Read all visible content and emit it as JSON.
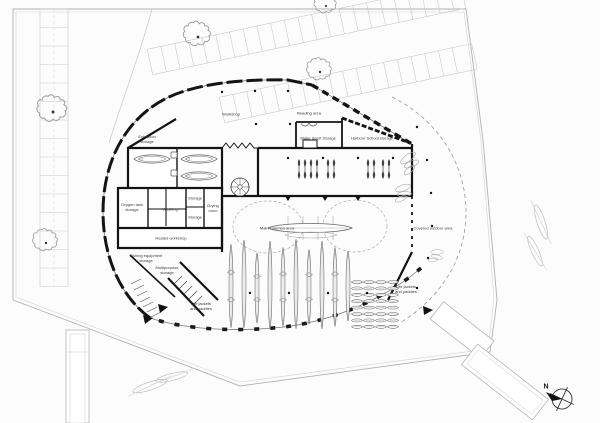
{
  "drawing": {
    "kind": "architectural ground-floor site plan",
    "building_shape": "organic egg-shaped boathouse with covered outdoor area",
    "colors": {
      "walls": "#141414",
      "site_lines": "#b0b0b0",
      "detail_lines": "#666666",
      "vegetation": "#9a9a9a",
      "glazing": "#1a1a1a",
      "text": "#3a3a3a",
      "background": "#fcfcfc"
    }
  },
  "labels": {
    "workshop": "Workshop",
    "reading_area": "Reading area",
    "water_sport_storage": "Water Sport storage",
    "harbour_school_storage": "Harbour School storage",
    "exhibition_storage": "Exhibition storage",
    "oxygen_tank_storage": "Oxygen tank storage",
    "washing": "Washing",
    "storage_upper": "Storage",
    "storage_lower": "Storage",
    "drying_room": "Drying room",
    "heated_workshop": "Heated workshop",
    "fishing_equipment_storage": "Fishing equipment storage",
    "multipurpose_storage": "Multipurpose storage",
    "life_jackets_left": "Life jackets and paddles",
    "life_jackets_right": "Life jackets and paddles",
    "main_common_area": "Main common area",
    "covered_outdoor_area": "Covered outdoor area",
    "north": "N"
  }
}
